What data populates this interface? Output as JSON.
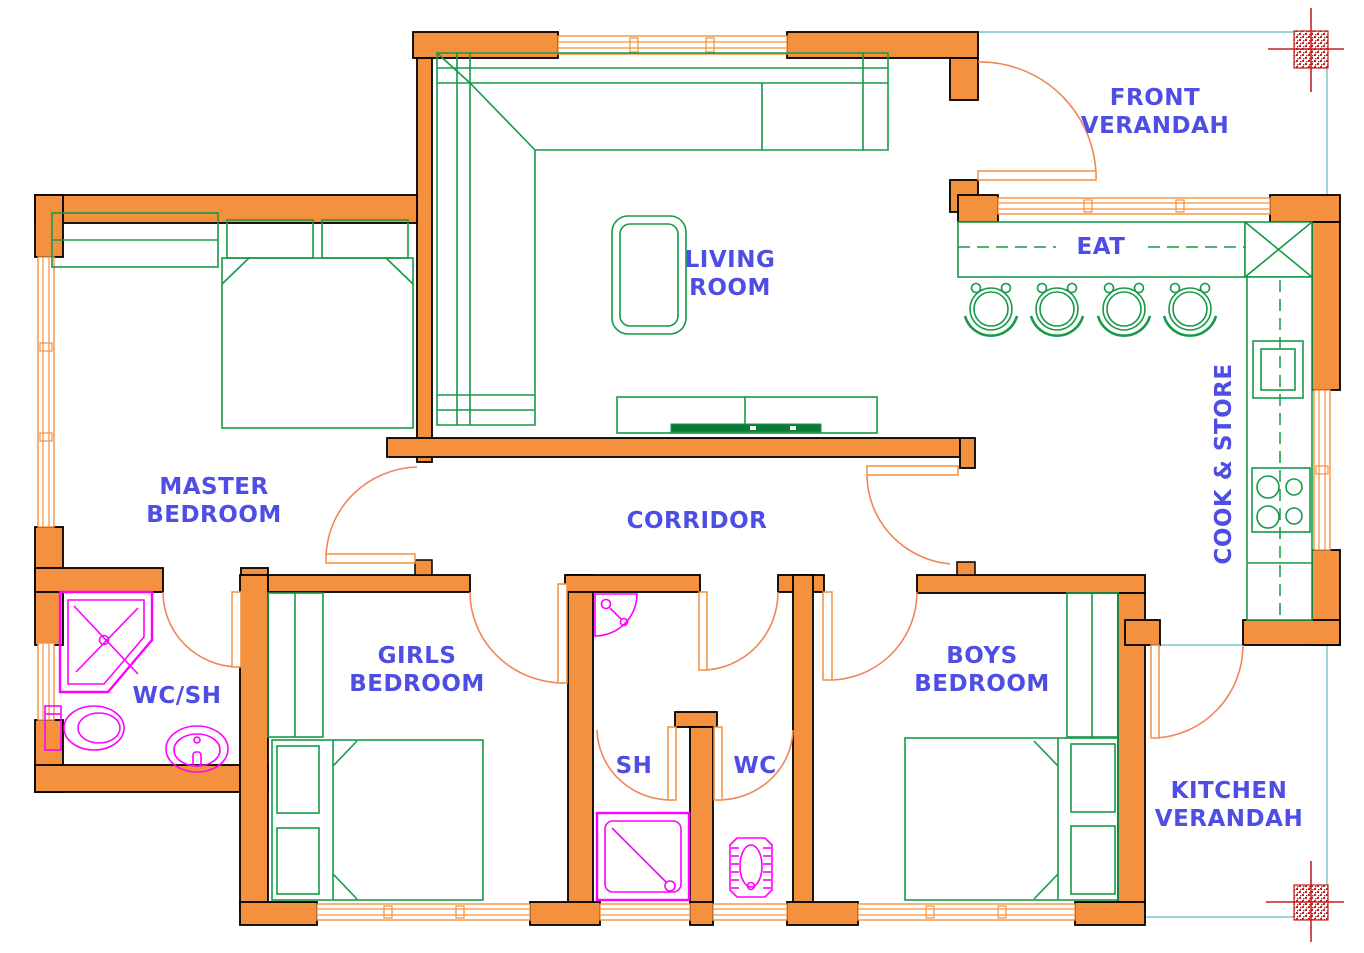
{
  "drawing": {
    "type": "architectural floor plan",
    "rooms": {
      "front_verandah": {
        "label": [
          "FRONT",
          "VERANDAH"
        ]
      },
      "living_room": {
        "label": [
          "LIVING",
          "ROOM"
        ]
      },
      "eat": {
        "label": "EAT"
      },
      "cook_store": {
        "label": "COOK & STORE"
      },
      "master_bedroom": {
        "label": [
          "MASTER",
          "BEDROOM"
        ]
      },
      "corridor": {
        "label": "CORRIDOR"
      },
      "wc_sh": {
        "label": "WC/SH"
      },
      "girls_bedroom": {
        "label": [
          "GIRLS",
          "BEDROOM"
        ]
      },
      "sh": {
        "label": "SH"
      },
      "wc": {
        "label": "WC"
      },
      "boys_bedroom": {
        "label": [
          "BOYS",
          "BEDROOM"
        ]
      },
      "kitchen_verandah": {
        "label": [
          "KITCHEN",
          "VERANDAH"
        ]
      }
    },
    "furniture": [
      "l-shaped-sofa",
      "coffee-table",
      "tv-console",
      "tv",
      "dining-counter",
      "corner-counter",
      "bar-stool-x4",
      "kitchen-counter",
      "kitchen-sink",
      "cooker-hob",
      "double-bed-master",
      "double-bed-girls",
      "double-bed-boys",
      "wardrobe-master",
      "wardrobe-girls",
      "wardrobe-boys"
    ],
    "fixtures": [
      "corner-shower",
      "toilet",
      "wash-basin",
      "corner-basin",
      "shower-tray",
      "squat-wc"
    ],
    "symbols": [
      "column-marker-ne",
      "column-marker-se",
      "door-swing-x10",
      "window-x9"
    ],
    "colors": {
      "wall": "#F4913E",
      "wall_outline": "#000000",
      "furniture": "#169A47",
      "fixtures": "#FF00FF",
      "door_swing": "#F2845C",
      "labels": "#4E4EE4",
      "verandah_edge": "#9FD5D9",
      "column_marker": "#C32222",
      "background": "#FFFFFF"
    }
  }
}
